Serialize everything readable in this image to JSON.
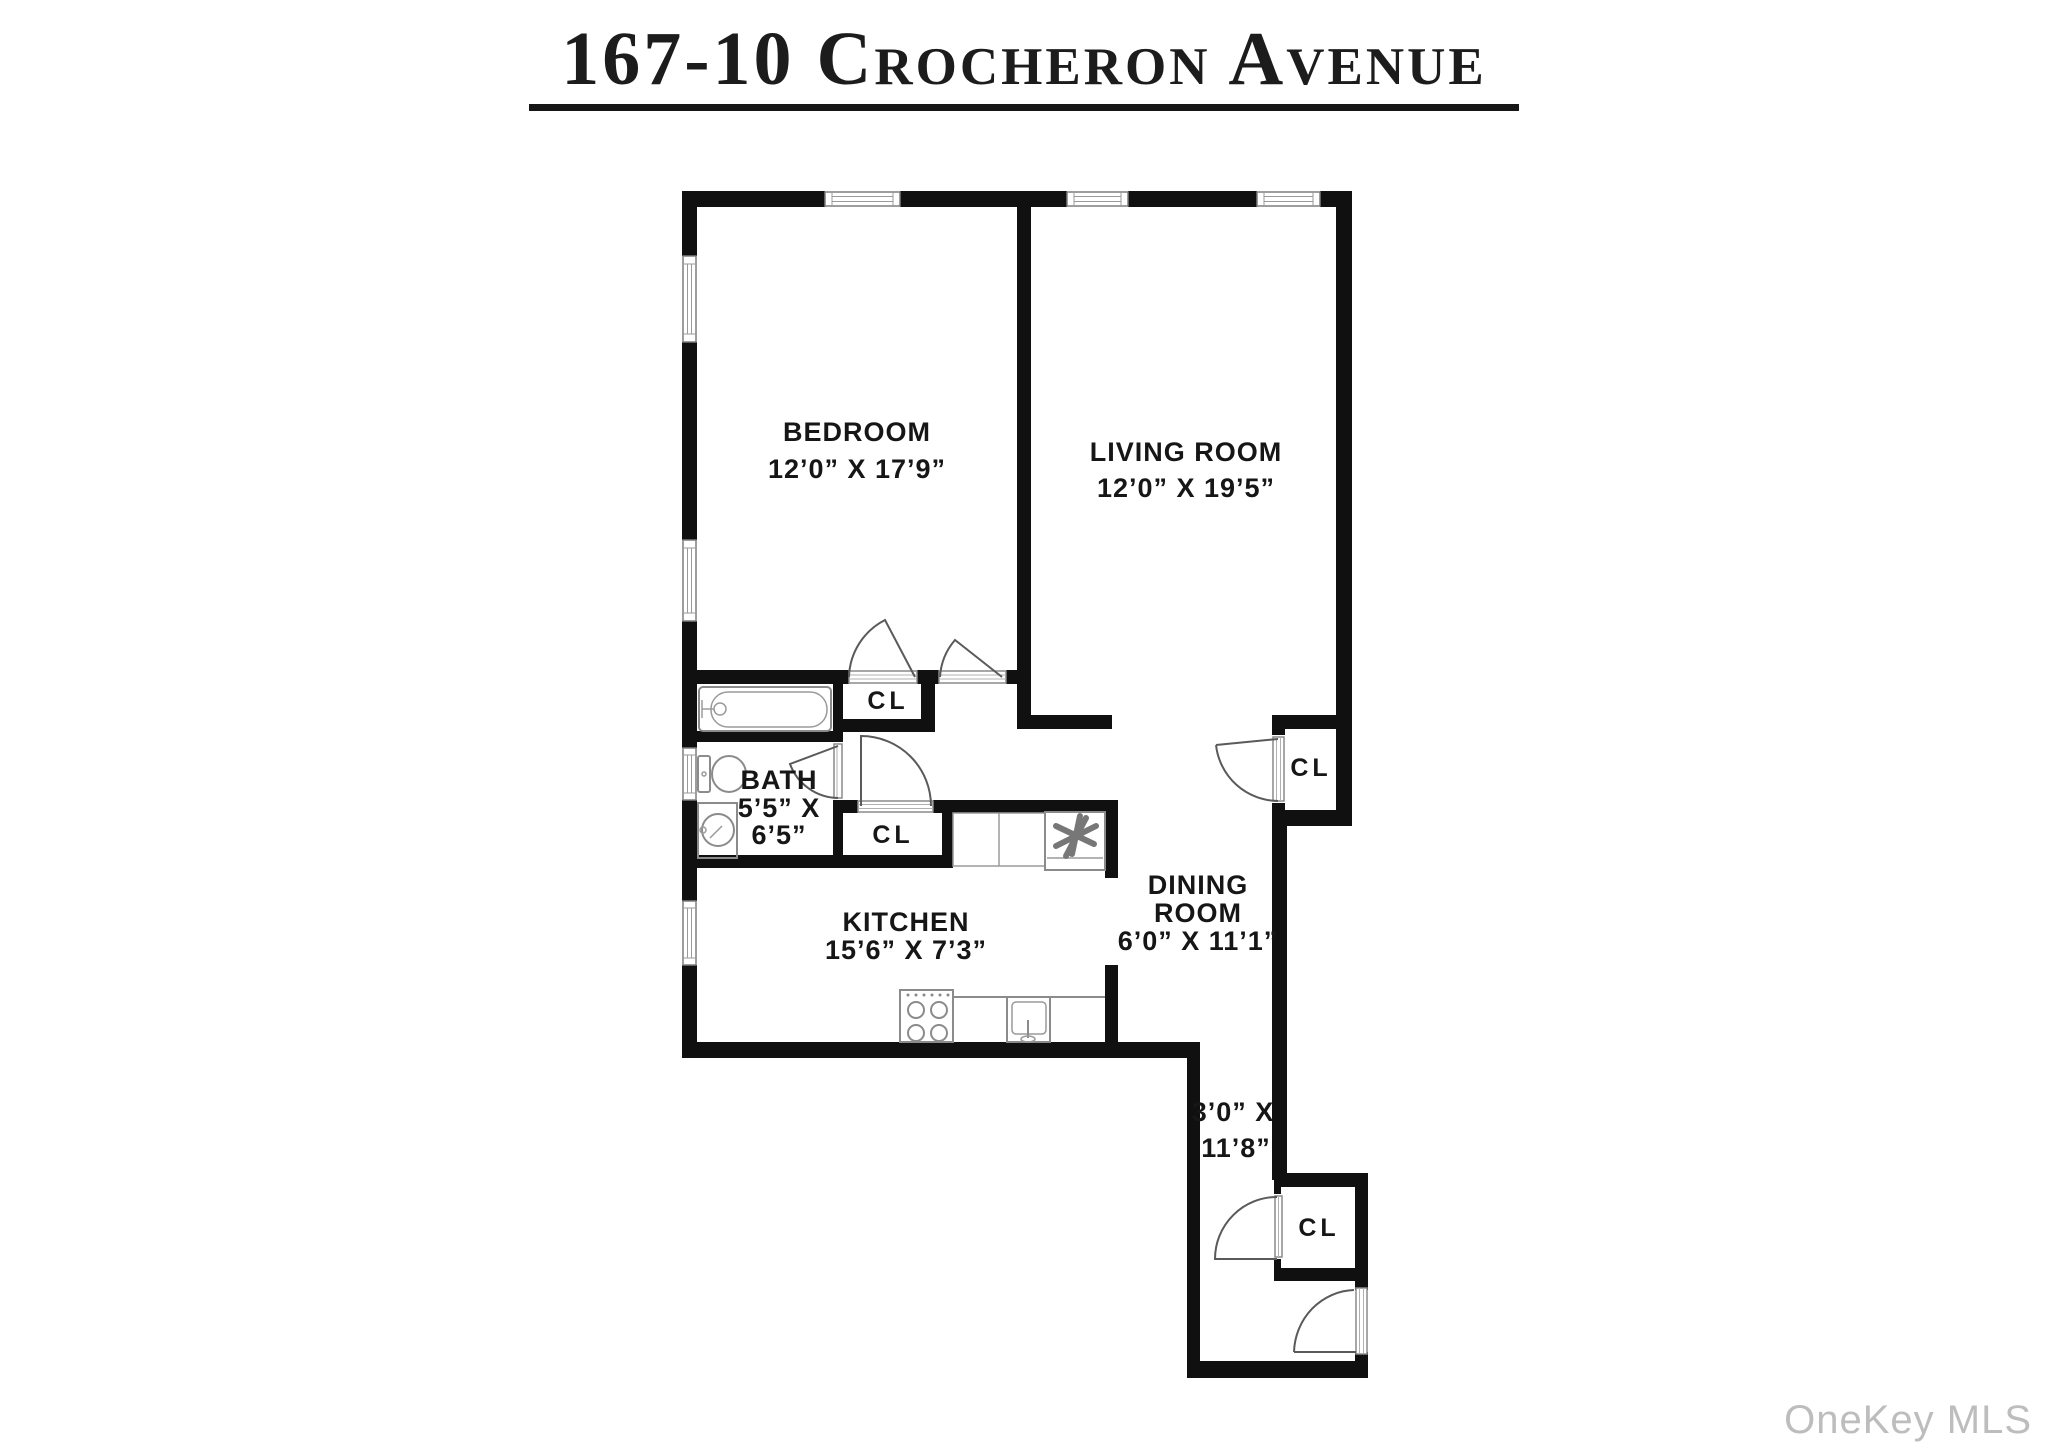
{
  "title": "167-10 Crocheron Avenue",
  "watermark": "OneKey MLS",
  "rooms": {
    "bedroom": {
      "name": "BEDROOM",
      "dims": "12’0” X 17’9”"
    },
    "living": {
      "name": "LIVING ROOM",
      "dims": "12’0” X 19’5”"
    },
    "bath": {
      "name": "BATH",
      "dims_line1": "5’5” X",
      "dims_line2": "6’5”"
    },
    "kitchen": {
      "name": "KITCHEN",
      "dims": "15’6” X 7’3”"
    },
    "dining": {
      "name_line1": "DINING",
      "name_line2": "ROOM",
      "dims": "6’0” X 11’1”"
    },
    "hall": {
      "dims_line1": "3’0” X",
      "dims_line2": "11’8”"
    }
  },
  "closets": {
    "bedroom_closet": "CL",
    "hall_closet": "CL",
    "dining_closet": "CL",
    "entry_closet": "CL"
  },
  "colors": {
    "wall": "#101010",
    "label_text": "#161616",
    "fixture_line": "#8b8b8b",
    "watermark_text": "#bdbdbd"
  }
}
